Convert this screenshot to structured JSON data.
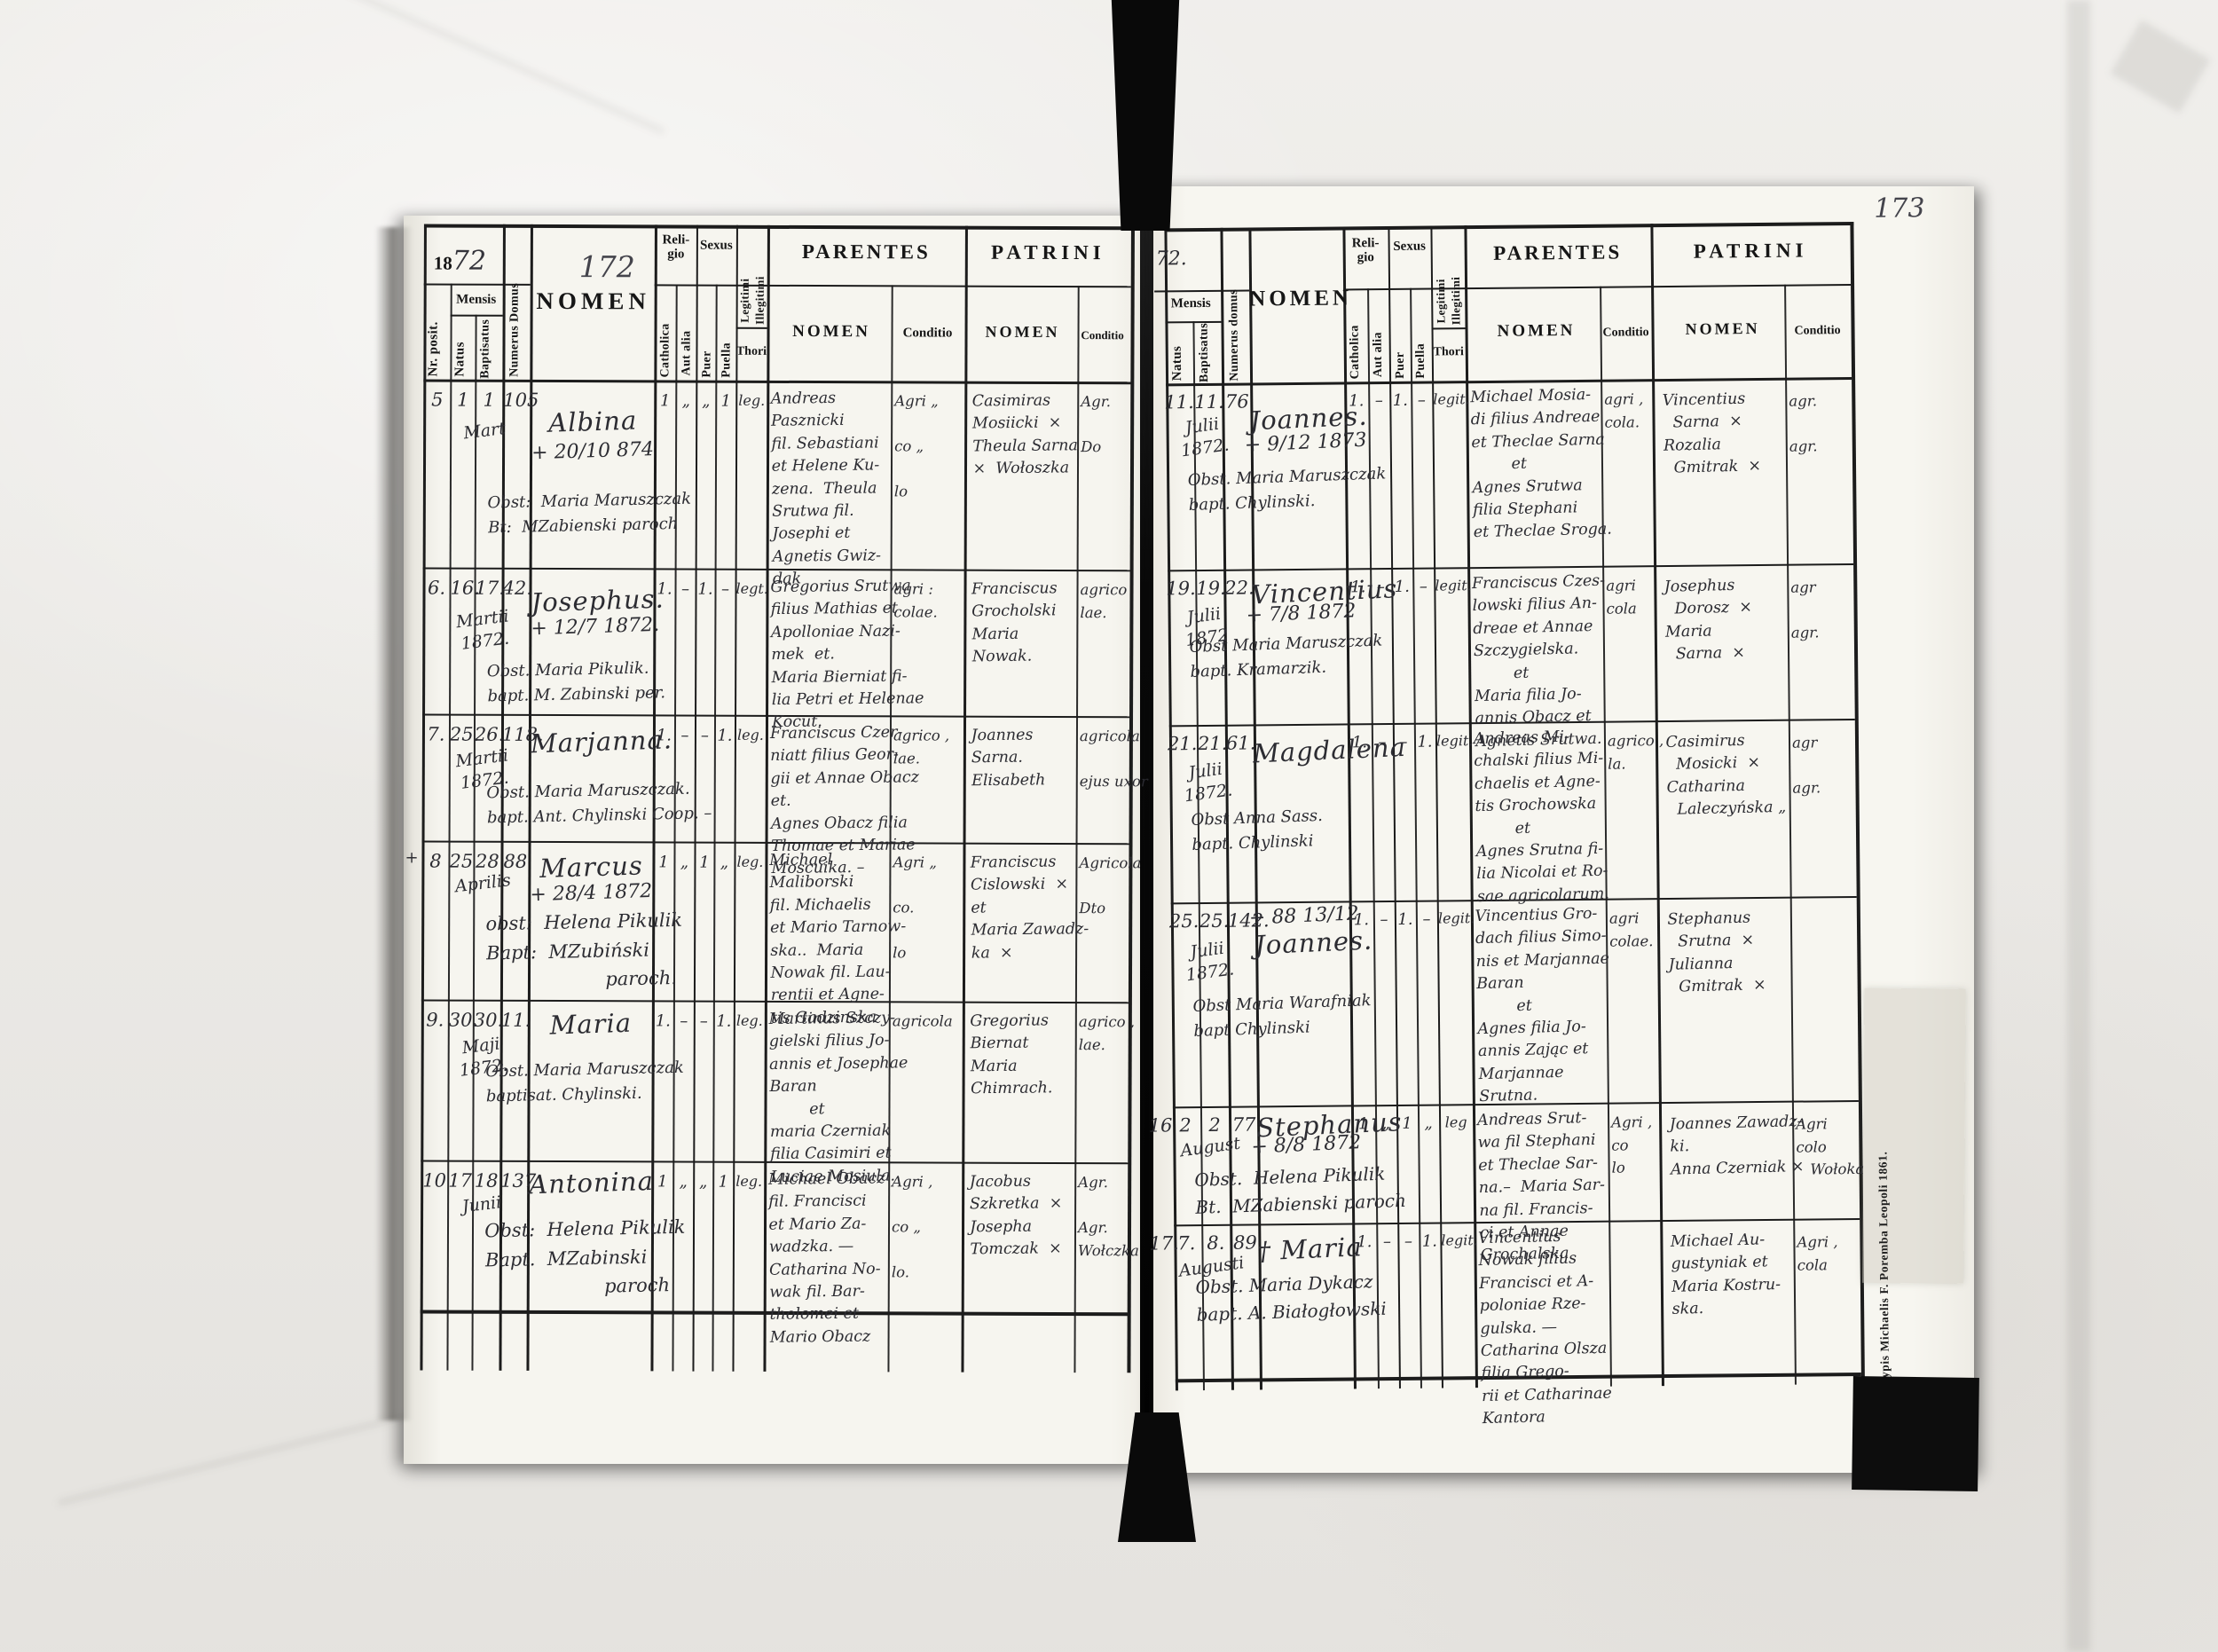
{
  "imprint": "Typis Michaelis F. Poremba Leopoli 1861.",
  "left": {
    "year_printed": "18",
    "year_hand": "72",
    "folio": "172",
    "header": {
      "nr": "Nr. posit.",
      "mensis": "Mensis",
      "natus": "Natus",
      "baptisatus": "Baptisatus",
      "domus": "Numerus Domus",
      "nomen": "NOMEN",
      "religio": "Reli-\ngio",
      "catholica": "Catholica",
      "aut_alia": "Aut alia",
      "sexus": "Sexus",
      "puer": "Puer",
      "puella": "Puella",
      "legitimi": "Legitimi",
      "illegitimi": "Illegitimi",
      "thori": "Thori",
      "parentes": "PARENTES",
      "patrini": "PATRINI",
      "nomen_sub": "NOMEN",
      "conditio": "Conditio"
    },
    "records": [
      {
        "nr": "5",
        "natus": "1",
        "baptisatus": "1",
        "month": "Mart",
        "house": "105",
        "name": "Albina",
        "death": "+ 20/10 874",
        "note": "Obst:  Maria Maruszczak\nBt:  MZabienski paroch",
        "religio_catholica": "1",
        "religio_aut_alia": "„",
        "sexus_puer": "„",
        "sexus_puella": "1",
        "thori": "leg.",
        "parentes": "Andreas\nPasznicki\nfil. Sebastiani\net Helene Ku-\nzena.  Theula\nSrutwa fil.\nJosephi et\nAgnetis Gwiz-\ndak",
        "parentes_conditio": "Agri „\n\nco „\n\nlo",
        "patrini": "Casimiras\nMosiicki  ×\nTheula Sarna\n×  Wołoszka",
        "patrini_conditio": "Agr.\n\nDo"
      },
      {
        "nr": "6.",
        "natus": "16.",
        "baptisatus": "17.",
        "month": "Martii\n1872.",
        "house": "42.",
        "name": "Josephus.",
        "death": "+ 12/7 1872.",
        "note": "Obst. Maria Pikulik.\nbapt. M. Zabinski per.",
        "religio_catholica": "1.",
        "religio_aut_alia": "–",
        "sexus_puer": "1.",
        "sexus_puella": "–",
        "thori": "legt.",
        "parentes": "Gregorius Srutwa\nfilius Mathias et\nApolloniae Nazi-\nmek  et.\nMaria Bierniat fi-\nlia Petri et Helenae\nKocut.",
        "parentes_conditio": "agri :\ncolae.",
        "patrini": "Franciscus\nGrocholski\nMaria\nNowak.",
        "patrini_conditio": "agrico\nlae."
      },
      {
        "nr": "7.",
        "natus": "25.",
        "baptisatus": "26.",
        "month": "Martii\n1872.",
        "house": "118.",
        "name": "Marjanna.",
        "death": "",
        "note": "Obst. Maria Maruszczak.\nbapt. Ant. Chylinski Coop. –",
        "religio_catholica": "1.",
        "religio_aut_alia": "–",
        "sexus_puer": "–",
        "sexus_puella": "1.",
        "thori": "leg.",
        "parentes": "Franciscus Czer-\nniatt filius Geor-\ngii et Annae Obacz\net.\nAgnes Obacz filia\nThomae et Mariae\nMoscuika. –",
        "parentes_conditio": "agrico ,\nlae.",
        "patrini": "Joannes\nSarna.\nElisabeth",
        "patrini_conditio": "agricola\n\nejus uxor"
      },
      {
        "margin_mark": "+",
        "nr": "8",
        "natus": "25",
        "baptisatus": "28",
        "month": "Aprilis",
        "house": "88",
        "name": "Marcus",
        "death": "+ 28/4 1872",
        "note": "obst:  Helena Pikulik\nBapt:  MZubiński\n                    paroch.",
        "religio_catholica": "1",
        "religio_aut_alia": "„",
        "sexus_puer": "1",
        "sexus_puella": "„",
        "thori": "leg.",
        "parentes": "Michael\nMaliborski\nfil. Michaelis\net Mario Tarnow-\nska..  Maria\nNowak fil. Lau-\nrentii et Agne-\ntis Gadzinska",
        "parentes_conditio": "Agri „\n\nco.\n\nlo",
        "patrini": "Franciscus\nCislowski  ×\net\nMaria Zawadz-\nka  ×",
        "patrini_conditio": "Agricola\n\nDto"
      },
      {
        "nr": "9.",
        "natus": "30.",
        "baptisatus": "30.",
        "month": "Maji\n1872.",
        "house": "11.",
        "name": "Maria",
        "death": "",
        "note": "Obst. Maria Maruszczak\nbaptisat. Chylinski.",
        "religio_catholica": "1.",
        "religio_aut_alia": "–",
        "sexus_puer": "–",
        "sexus_puella": "1.",
        "thori": "leg.",
        "parentes": "Martinus Szczy-\ngielski filius Jo-\nannis et Josephae\nBaran\n        et\nmaria Czerniak\nfilia Casimiri et\nLuciae Mosiula.",
        "parentes_conditio": "agricola",
        "patrini": "Gregorius\nBiernat\nMaria\nChimrach.",
        "patrini_conditio": "agrico ,\nlae."
      },
      {
        "nr": "10",
        "natus": "17",
        "baptisatus": "18",
        "month": "Junii",
        "house": "137",
        "name": "Antonina",
        "death": "",
        "note": "Obst:  Helena Pikulik\nBapt.  MZabinski\n                    paroch",
        "religio_catholica": "1",
        "religio_aut_alia": "„",
        "sexus_puer": "„",
        "sexus_puella": "1",
        "thori": "leg.",
        "parentes": "Michael Obacz\nfil. Francisci\net Mario Za-\nwadzka. —\nCatharina No-\nwak fil. Bar-\ntholomei et\nMario Obacz",
        "parentes_conditio": "Agri ,\n\nco „\n\nlo.",
        "patrini": "Jacobus\nSzkretka  ×\nJosepha\nTomczak  ×",
        "patrini_conditio": "Agr.\n\nAgr.\nWołczka"
      }
    ]
  },
  "right": {
    "year_hand": "72.",
    "folio": "173",
    "header": {
      "mensis": "Mensis",
      "natus": "Natus",
      "baptisatus": "Baptisatus",
      "domus": "Numerus domus",
      "nomen": "NOMEN",
      "religio": "Reli-\ngio",
      "catholica": "Catholica",
      "aut_alia": "Aut alia",
      "sexus": "Sexus",
      "puer": "Puer",
      "puella": "Puella",
      "legitimi": "Legitimi",
      "illegitimi": "Illegitimi",
      "thori": "Thori",
      "parentes": "PARENTES",
      "patrini": "PATRINI",
      "nomen_sub": "NOMEN",
      "conditio": "Conditio"
    },
    "records": [
      {
        "natus": "11.",
        "baptisatus": "11.",
        "month": "Julii\n1872.",
        "house": "76",
        "name": "Joannes.",
        "death": "+ 9/12 1873",
        "note": "Obst. Maria Maruszczak\nbapt. Chylinski.",
        "religio_catholica": "1.",
        "religio_aut_alia": "–",
        "sexus_puer": "1.",
        "sexus_puella": "–",
        "thori": "legit.",
        "parentes": "Michael Mosia-\ndi filius Andreae\net Theclae Sarna\n        et\nAgnes Srutwa\nfilia Stephani\net Theclae Sroga.",
        "parentes_conditio": "agri ,\ncola.",
        "patrini": "Vincentius\n  Sarna  ×\nRozalia\n  Gmitrak  ×",
        "patrini_conditio": "agr.\n\nagr."
      },
      {
        "natus": "19.",
        "baptisatus": "19.",
        "month": "Julii\n1872",
        "house": "22.",
        "name": "Vincentius",
        "death": "+ 7/8 1872",
        "note": "Obst Maria Maruszczak\nbapt. Kramarzik.",
        "religio_catholica": "1.",
        "religio_aut_alia": "–",
        "sexus_puer": "1.",
        "sexus_puella": "–",
        "thori": "legit.",
        "parentes": "Franciscus Czes-\nlowski filius An-\ndreae et Annae\nSzczygielska.\n        et\nMaria filia Jo-\nannis Obacz et\nAgnetis Srutwa.",
        "parentes_conditio": "agri\ncola",
        "patrini": "Josephus\n  Dorosz  ×\nMaria\n  Sarna  ×",
        "patrini_conditio": "agr\n\nagr."
      },
      {
        "natus": "21.",
        "baptisatus": "21.",
        "month": "Julii\n1872.",
        "house": "61.",
        "name": "Magdalena",
        "death": "",
        "note": "Obst Anna Sass.\nbapt. Chylinski",
        "religio_catholica": "1.",
        "religio_aut_alia": "–",
        "sexus_puer": "–",
        "sexus_puella": "1.",
        "thori": "legit.",
        "parentes": "Andreas Mi-\nchalski filius Mi-\nchaelis et Agne-\ntis Grochowska\n        et\nAgnes Srutna fi-\nlia Nicolai et Ro-\nsae agricolarum.",
        "parentes_conditio": "agrico ,\nla.",
        "patrini": "Casimirus\n  Mosicki  ×\nCatharina\n  Laleczyńska „",
        "patrini_conditio": "agr\n\nagr."
      },
      {
        "natus": "25.",
        "baptisatus": "25.",
        "month": "Julii\n1872.",
        "house": "142.",
        "name": "Joannes.",
        "death": "+ 88 13/12",
        "note": "Obst Maria Warafniak\nbapt Chylinski",
        "religio_catholica": "1.",
        "religio_aut_alia": "–",
        "sexus_puer": "1.",
        "sexus_puella": "–",
        "thori": "legit.",
        "parentes": "Vincentius Gro-\ndach filius Simo-\nnis et Marjannae\nBaran\n        et\nAgnes filia Jo-\nannis Zając et\nMarjannae\nSrutna.",
        "parentes_conditio": "agri\ncolae.",
        "patrini": "Stephanus\n  Srutna  ×\nJulianna\n  Gmitrak  ×",
        "patrini_conditio": ""
      },
      {
        "nr": "16",
        "natus": "2",
        "baptisatus": "2",
        "month": "August",
        "house": "77",
        "name": "Stephanus",
        "death": "+ 8/8 1872",
        "note": "Obst.  Helena Pikulik\nBt.  MZabienski paroch",
        "religio_catholica": "1",
        "religio_aut_alia": "„",
        "sexus_puer": "1",
        "sexus_puella": "„",
        "thori": "leg",
        "parentes": "Andreas Srut-\nwa fil Stephani\net Theclae Sar-\nna.–  Maria Sar-\nna fil. Francis-\nci et Annae\nGrochalska",
        "parentes_conditio": "Agri ,\nco\nlo",
        "patrini": "Joannes Zawadz-\nki.\nAnna Czerniak ×",
        "patrini_conditio": "Agri\ncolo\n   Wołoka"
      },
      {
        "nr": "17.",
        "natus": "7.",
        "baptisatus": "8.",
        "month": "Augusti",
        "house": "89",
        "name": "† Maria",
        "death": "",
        "note": "Obst. Maria Dykacz\nbapt. A. Białogłowski",
        "religio_catholica": "1.",
        "religio_aut_alia": "–",
        "sexus_puer": "–",
        "sexus_puella": "1.",
        "thori": "legit.",
        "parentes": "Vincentius\nNowak filius\nFrancisci et A-\npoloniae Rze-\ngulska. —\nCatharina Olsza\nfilia Grego-\nrii et Catharinae\nKantora",
        "parentes_conditio": "",
        "patrini": "Michael Au-\ngustyniak et\nMaria Kostru-\nska.",
        "patrini_conditio": "Agri ,\ncola"
      }
    ]
  }
}
